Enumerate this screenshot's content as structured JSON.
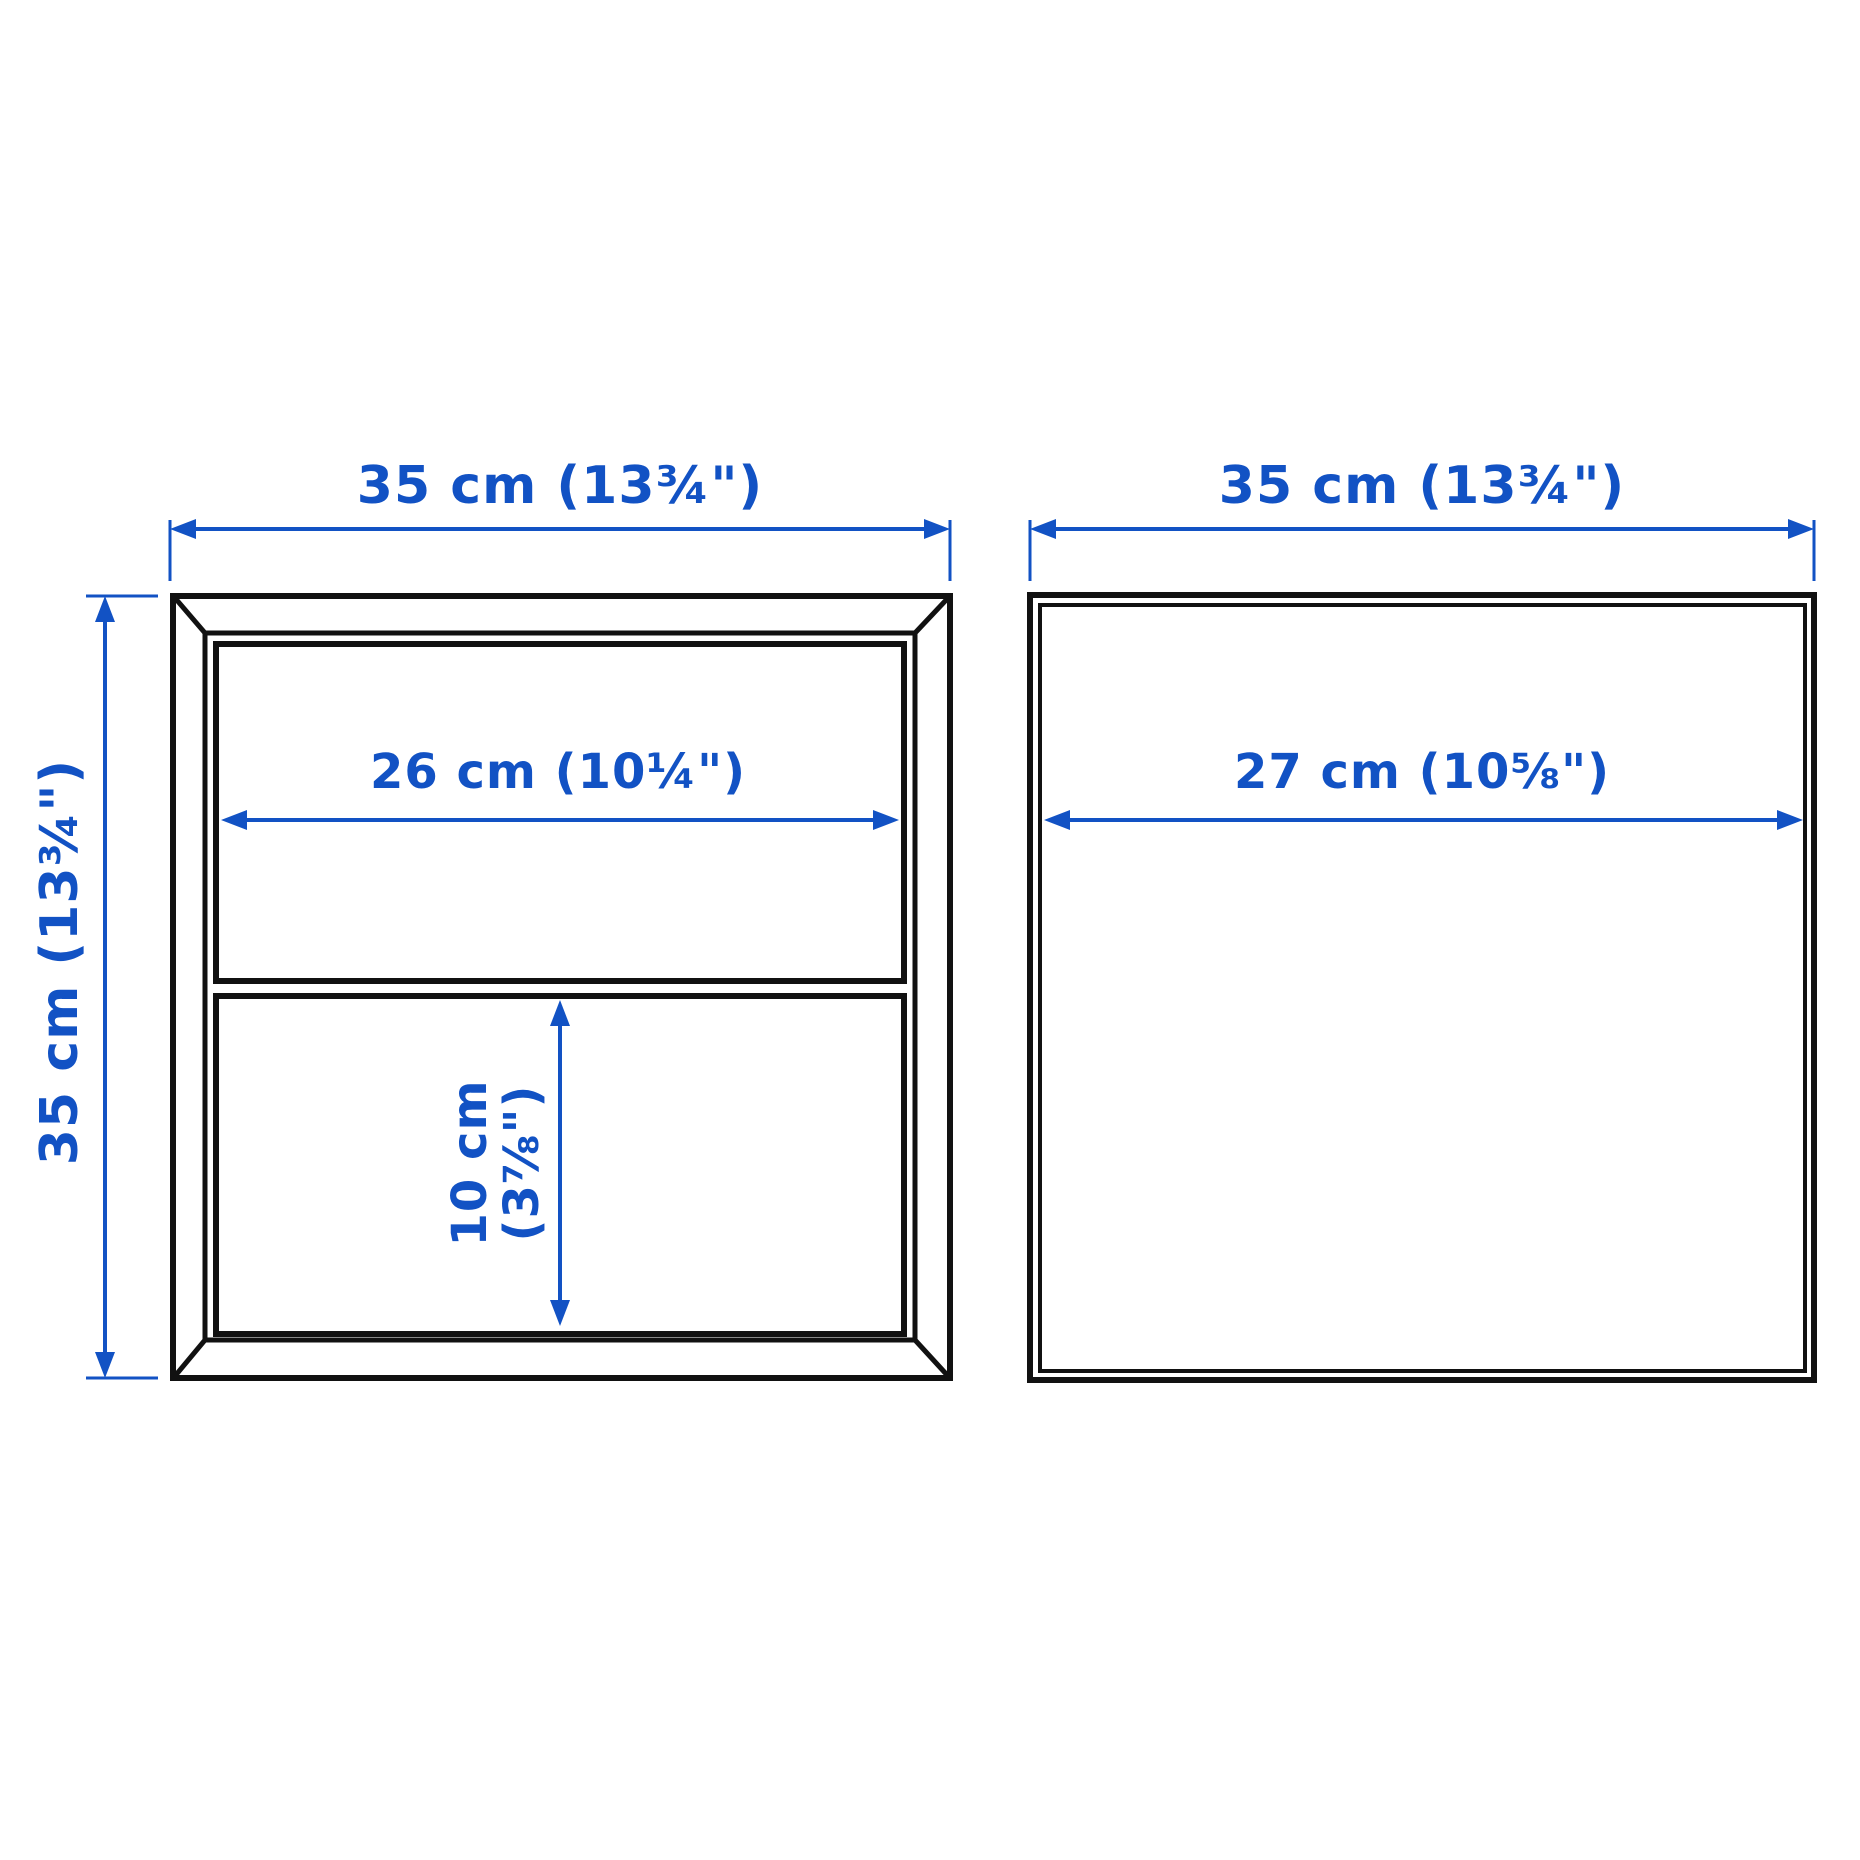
{
  "colors": {
    "dimension_blue": "#1252c4",
    "outline_black": "#111111",
    "background": "#ffffff"
  },
  "front_view": {
    "width_label": "35 cm (13¾\")",
    "height_label": "35 cm (13¾\")",
    "shelf_width_label": "26 cm (10¼\")",
    "compartment_height_label_line1": "10 cm",
    "compartment_height_label_line2": "(3⅞\")"
  },
  "side_view": {
    "width_label": "35 cm (13¾\")",
    "depth_label": "27 cm (10⅝\")"
  }
}
